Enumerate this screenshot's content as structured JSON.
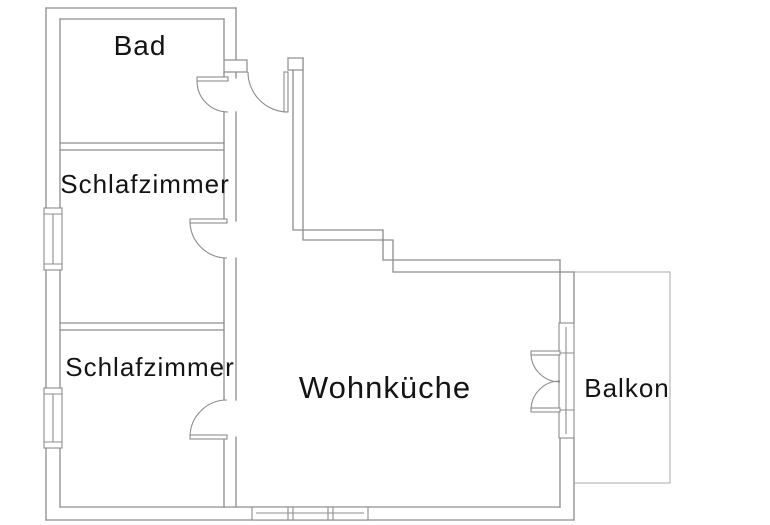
{
  "rooms": {
    "bad": {
      "label": "Bad"
    },
    "schlafzimmer_1": {
      "label": "Schlafzimmer"
    },
    "schlafzimmer_2": {
      "label": "Schlafzimmer"
    },
    "wohnkueche": {
      "label": "Wohnküche"
    },
    "balkon": {
      "label": "Balkon"
    }
  },
  "features": {
    "doors": [
      "entrance-door",
      "bad-door",
      "bedroom1-door",
      "bedroom2-door",
      "balcony-double-door"
    ],
    "windows": [
      "left-wall-window-top",
      "left-wall-window-bottom",
      "bottom-wall-window",
      "balcony-wall-window"
    ]
  },
  "colors": {
    "background": "#ffffff",
    "wall_line": "#8d8d8d",
    "thin_line": "#a8a8a8",
    "text": "#141414"
  }
}
